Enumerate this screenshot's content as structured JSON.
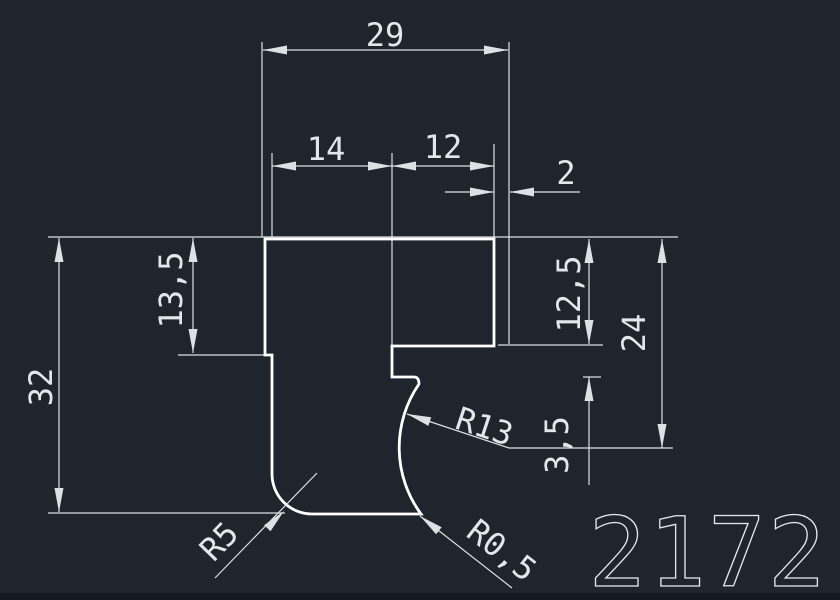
{
  "colors": {
    "bg": "#1f252d",
    "bg-strip": "#151a20",
    "line": "#dde1e4",
    "profile": "#ffffff",
    "text": "#e4e7ea"
  },
  "part_number": "2172",
  "dimensions": {
    "total_width": "29",
    "left_width": "14",
    "mid_width": "12",
    "lip_width": "2",
    "total_height": "32",
    "left_step_height": "13,5",
    "right_flange_height": "12,5",
    "right_height": "24",
    "step_gap": "3,5"
  },
  "radii": {
    "concave": "R13",
    "fillet": "R5",
    "corner": "R0,5"
  }
}
